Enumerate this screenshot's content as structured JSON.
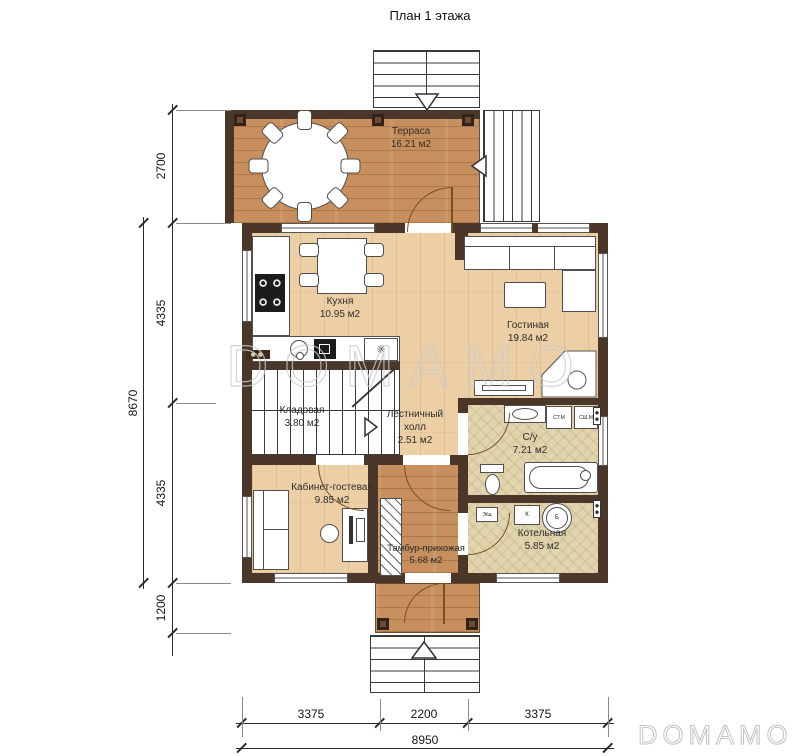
{
  "title": "План 1 этажа",
  "watermark": {
    "main": "DOMAMO",
    "corner": "DOMAMO"
  },
  "rooms": {
    "terrace": {
      "name": "Терраса",
      "area": "16.21 м2"
    },
    "kitchen": {
      "name": "Кухня",
      "area": "10.95 м2"
    },
    "living": {
      "name": "Гостиная",
      "area": "19.84 м2"
    },
    "pantry": {
      "name": "Кладовая",
      "area": "3.80 м2"
    },
    "stair_hall": {
      "name": "Лестничный холл",
      "area": "2.51 м2"
    },
    "office": {
      "name": "Кабинет-гостевая",
      "area": "9.85 м2"
    },
    "vestibule": {
      "name": "Тамбур-прихожая",
      "area": "5.68 м2"
    },
    "bathroom": {
      "name": "С/у",
      "area": "7.21 м2"
    },
    "boiler": {
      "name": "Котельная",
      "area": "5.85 м2"
    }
  },
  "equipment": {
    "washing_machine": "СТ.М",
    "drying_machine": "СШ.М",
    "electrical_panel": "Э/щ",
    "boiler_unit": "К",
    "tank": "Б",
    "fridge_symbol": "✳"
  },
  "dimensions": {
    "left": [
      "2700",
      "4335",
      "4335",
      "1200"
    ],
    "left_total": "8670",
    "bottom": [
      "3375",
      "2200",
      "3375"
    ],
    "bottom_total": "8950"
  },
  "colors": {
    "wall": "#4b3729",
    "wood_light": "#eccfa5",
    "wood_medium": "#c78f5d",
    "tile": "#e2d5ae"
  }
}
